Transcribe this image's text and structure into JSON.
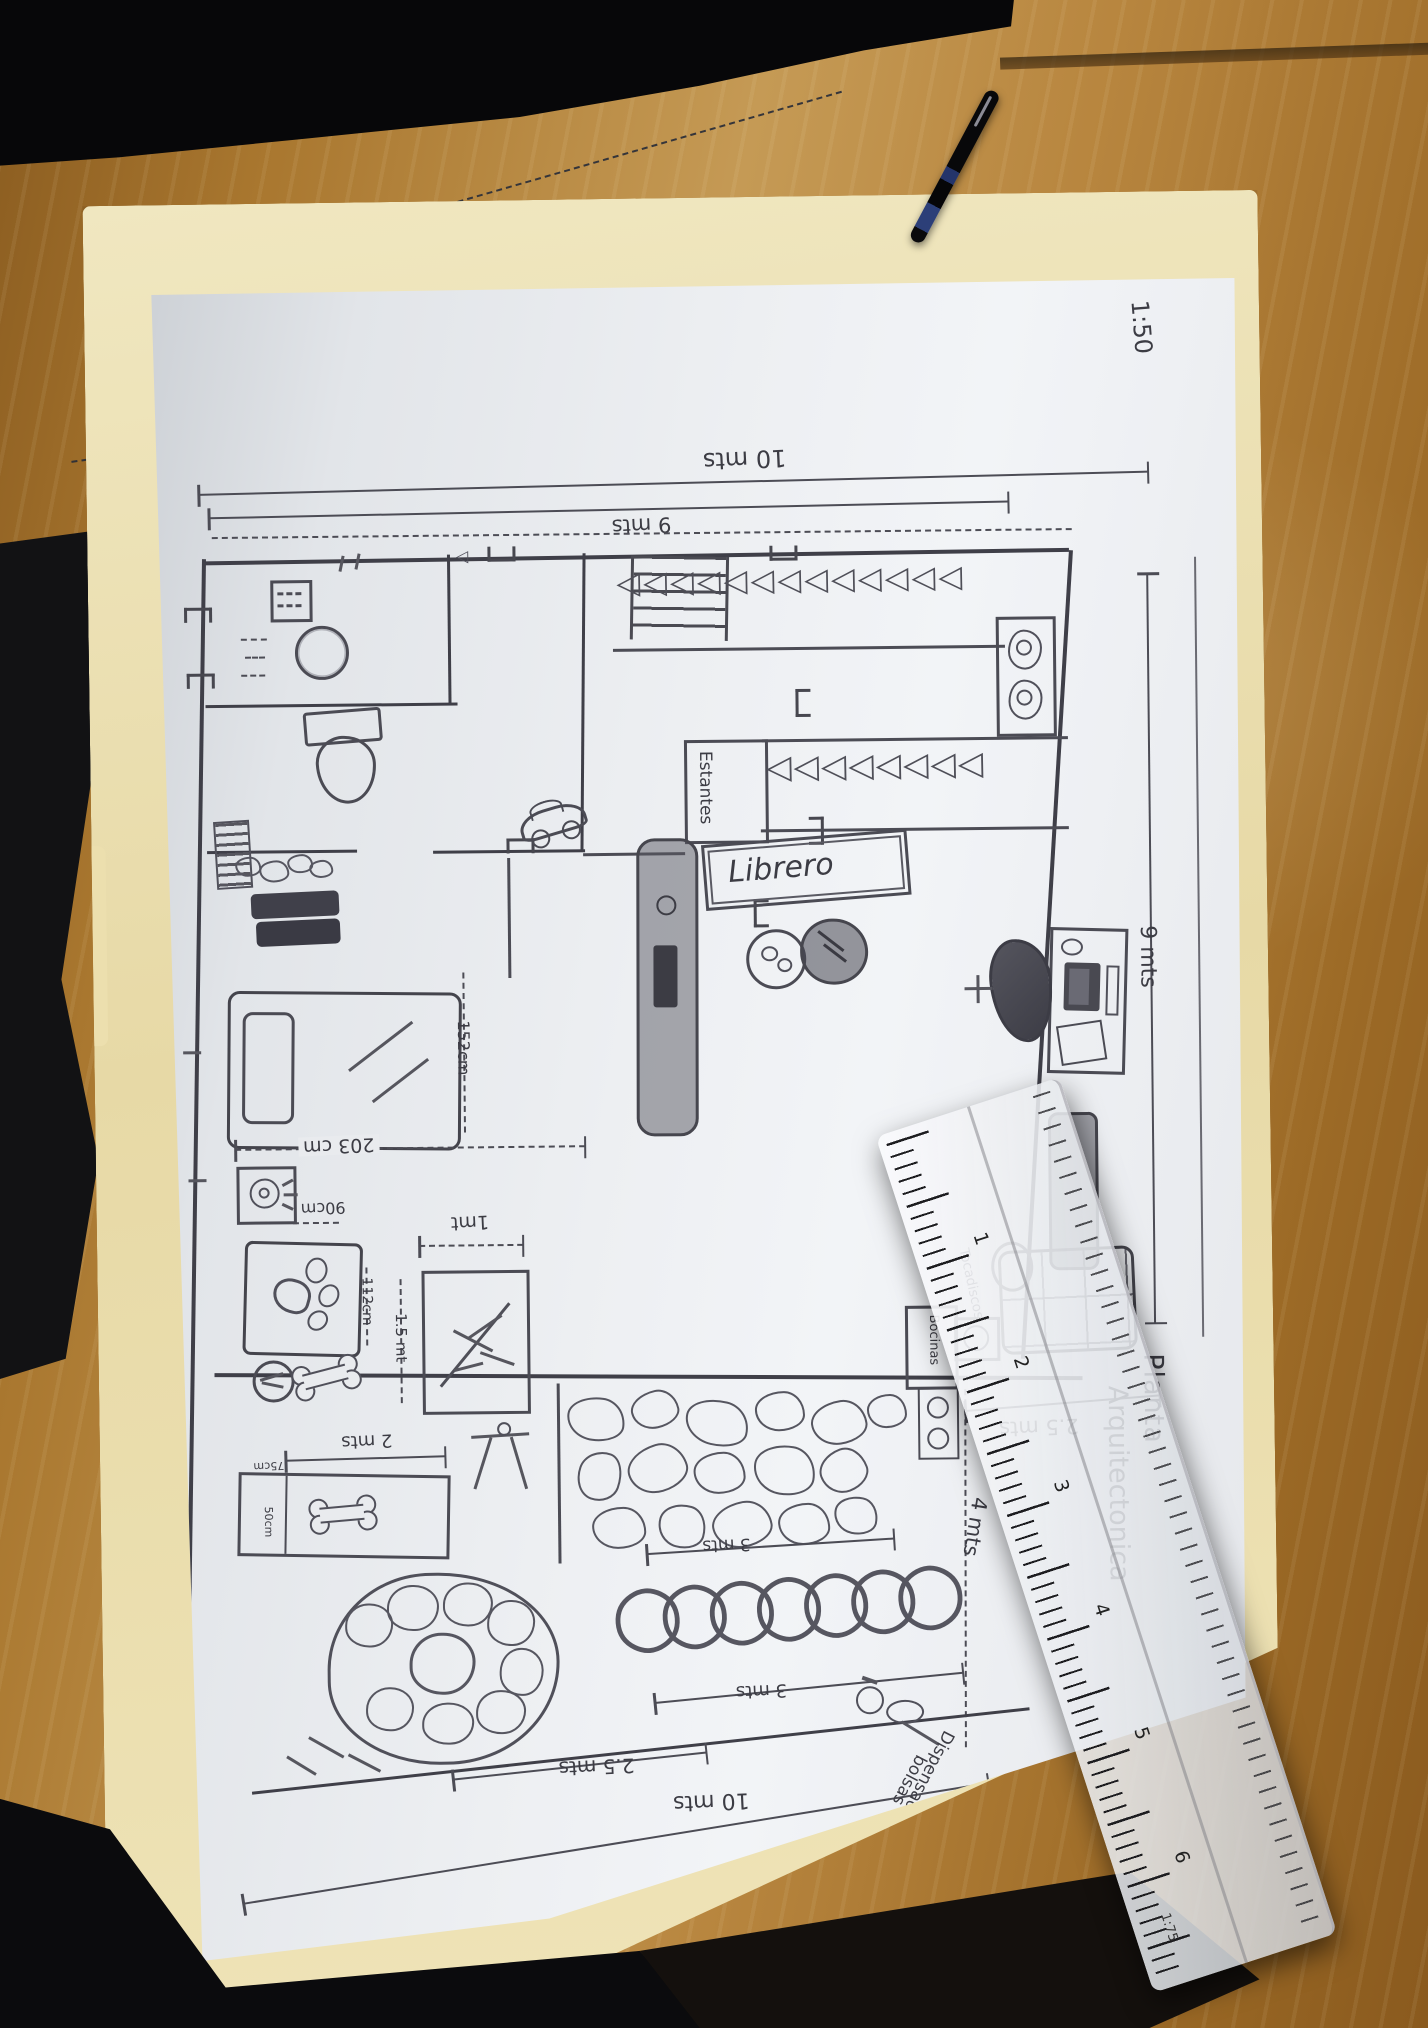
{
  "plan": {
    "scale": "1:50",
    "title_col1": "Planta",
    "title_col2": "Arquitectonica",
    "dims": {
      "top_outer": "10 mts",
      "top_inner": "9 mts",
      "right_height": "9 mts",
      "terrace": "2.5 mts",
      "patio_right": "4 mts",
      "bottom_short": "2.5 mts",
      "bottom_outer": "10 mts",
      "tunnel_upper": "3 mts",
      "tunnel_lower": "3 mts",
      "left_height": "6 mts",
      "bed_width": "203 cm",
      "bed_length": "152cm",
      "fan": "90cm",
      "dog_bed": "112cm",
      "planter_w": "1mt",
      "planter_h": "1.5 mt",
      "kennel_w": "2 mts",
      "kennel_d": "75cm",
      "kennel_h": "50cm"
    },
    "labels": {
      "librero": "Librero",
      "estantes": "Estantes",
      "bocinas": "Bocinas",
      "tocadiscos": "Tocadiscos",
      "dispensador_1": "Dispensador",
      "dispensador_2": "bolsas"
    },
    "icons": {
      "shelf_row1": "◁◁◁◁◁◁◁◁◁◁◁◁◁",
      "shelf_row2": "◁◁◁◁◁◁◁◁",
      "tunnel_rings": "○○○○○○○",
      "door_arrow": "◁"
    }
  },
  "ruler": {
    "scale_label": "1:75",
    "numbers": [
      "1",
      "2",
      "3",
      "4",
      "5",
      "6"
    ]
  },
  "colors": {
    "pencil": "#4b4b54",
    "paper": "#e9ebee",
    "folder": "#ece0b4",
    "wood": "#a97b33"
  }
}
